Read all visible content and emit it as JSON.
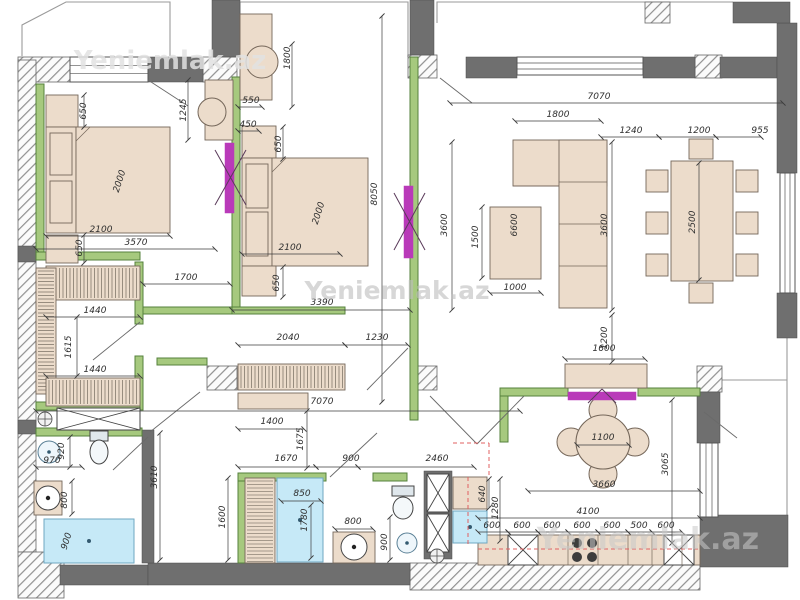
{
  "page": {
    "title": "Apartment floor plan drawing"
  },
  "watermark_text": "Yeniemlak.az",
  "colors": {
    "wall": "#6f6f6f",
    "wall_stroke": "#4c4c4c",
    "green_fill": "#a6c97e",
    "green_stroke": "#55813c",
    "furniture_fill": "#ecdccb",
    "furniture_stroke": "#75675a",
    "blue_fill": "#c6e9f7",
    "blue_stroke": "#6fa7c2",
    "magenta": "#b93ab9",
    "red_dash": "#e06060",
    "dim_line": "#3c3c3c",
    "swing": "#6a6a6a",
    "outline": "#9a9a9a",
    "stripe": "#5f564c",
    "hatch_line": "#909090"
  },
  "plan": {
    "hatched_walls": [
      [
        18,
        57,
        52,
        25
      ],
      [
        203,
        57,
        34,
        25
      ],
      [
        408,
        55,
        29,
        23
      ],
      [
        695,
        55,
        27,
        23
      ],
      [
        645,
        2,
        25,
        21
      ],
      [
        18,
        60,
        18,
        492
      ],
      [
        18,
        552,
        46,
        46
      ],
      [
        207,
        366,
        30,
        24
      ],
      [
        410,
        366,
        27,
        24
      ],
      [
        697,
        366,
        25,
        26
      ],
      [
        410,
        563,
        290,
        27
      ]
    ],
    "solid_walls": [
      [
        212,
        0,
        28,
        57
      ],
      [
        410,
        0,
        24,
        55
      ],
      [
        466,
        57,
        51,
        21
      ],
      [
        643,
        57,
        52,
        21
      ],
      [
        720,
        57,
        57,
        21
      ],
      [
        777,
        23,
        20,
        150
      ],
      [
        777,
        293,
        20,
        45
      ],
      [
        733,
        2,
        57,
        21
      ],
      [
        148,
        57,
        55,
        25
      ],
      [
        697,
        392,
        23,
        51
      ],
      [
        700,
        515,
        88,
        52
      ],
      [
        60,
        565,
        88,
        20
      ],
      [
        148,
        563,
        262,
        22
      ],
      [
        18,
        246,
        18,
        16
      ],
      [
        18,
        420,
        18,
        14
      ],
      [
        142,
        430,
        12,
        133
      ],
      [
        424,
        471,
        28,
        88
      ]
    ],
    "windows": [
      [
        70,
        57,
        78,
        25,
        "h"
      ],
      [
        517,
        57,
        126,
        18,
        "h"
      ],
      [
        780,
        173,
        15,
        120,
        "v"
      ],
      [
        700,
        443,
        18,
        74,
        "v"
      ]
    ],
    "green_walls": [
      [
        36,
        84,
        8,
        168
      ],
      [
        36,
        252,
        104,
        8
      ],
      [
        232,
        77,
        8,
        233
      ],
      [
        410,
        57,
        8,
        363
      ],
      [
        135,
        262,
        8,
        62
      ],
      [
        135,
        356,
        8,
        54
      ],
      [
        36,
        402,
        104,
        8
      ],
      [
        36,
        428,
        106,
        8
      ],
      [
        238,
        473,
        8,
        90
      ],
      [
        238,
        473,
        88,
        8
      ],
      [
        373,
        473,
        34,
        8
      ],
      [
        500,
        388,
        68,
        8
      ],
      [
        638,
        388,
        62,
        8
      ],
      [
        500,
        396,
        8,
        46
      ],
      [
        143,
        307,
        97,
        7
      ],
      [
        232,
        307,
        113,
        7
      ],
      [
        157,
        358,
        50,
        7
      ]
    ],
    "furniture": [
      [
        46,
        95,
        32,
        32
      ],
      [
        46,
        127,
        30,
        106
      ],
      [
        76,
        127,
        94,
        106
      ],
      [
        50,
        133,
        22,
        42
      ],
      [
        50,
        181,
        22,
        42
      ],
      [
        46,
        235,
        32,
        28
      ],
      [
        205,
        80,
        28,
        60
      ],
      [
        240,
        14,
        32,
        86
      ],
      [
        242,
        126,
        34,
        32
      ],
      [
        242,
        158,
        30,
        108
      ],
      [
        272,
        158,
        96,
        108
      ],
      [
        246,
        164,
        22,
        44
      ],
      [
        246,
        212,
        22,
        44
      ],
      [
        242,
        266,
        34,
        30
      ],
      [
        238,
        393,
        70,
        16
      ],
      [
        513,
        140,
        94,
        46
      ],
      [
        559,
        140,
        48,
        168
      ],
      [
        490,
        207,
        51,
        72
      ],
      [
        671,
        161,
        62,
        120
      ],
      [
        646,
        170,
        22,
        22
      ],
      [
        646,
        212,
        22,
        22
      ],
      [
        646,
        254,
        22,
        22
      ],
      [
        736,
        170,
        22,
        22
      ],
      [
        736,
        212,
        22,
        22
      ],
      [
        736,
        254,
        22,
        22
      ],
      [
        689,
        139,
        24,
        20
      ],
      [
        689,
        283,
        24,
        20
      ],
      [
        565,
        364,
        82,
        24
      ],
      [
        478,
        535,
        222,
        30
      ],
      [
        453,
        477,
        34,
        32
      ],
      [
        34,
        481,
        28,
        34
      ],
      [
        333,
        532,
        42,
        31
      ]
    ],
    "striped_items": [
      [
        46,
        266,
        94,
        34,
        "v"
      ],
      [
        36,
        268,
        20,
        126,
        "h"
      ],
      [
        46,
        378,
        94,
        28,
        "v"
      ],
      [
        238,
        364,
        107,
        26,
        "v"
      ],
      [
        245,
        478,
        30,
        85,
        "h"
      ]
    ],
    "xboxes": [
      [
        57,
        408,
        83,
        22
      ],
      [
        427,
        474,
        22,
        38
      ],
      [
        427,
        514,
        22,
        38
      ],
      [
        508,
        535,
        30,
        30
      ],
      [
        664,
        535,
        30,
        30
      ]
    ],
    "blue_items": [
      [
        44,
        519,
        90,
        44
      ],
      [
        277,
        478,
        46,
        84
      ],
      [
        453,
        511,
        34,
        32
      ]
    ],
    "circles": [
      [
        212,
        112,
        14,
        "chair"
      ],
      [
        262,
        62,
        16,
        "chair"
      ],
      [
        49,
        452,
        11,
        "sink"
      ],
      [
        48,
        498,
        12,
        "drum"
      ],
      [
        354,
        547,
        13,
        "drum"
      ],
      [
        407,
        543,
        10,
        "sink"
      ],
      [
        603,
        410,
        14,
        "chairf"
      ],
      [
        603,
        474,
        14,
        "chairf"
      ],
      [
        571,
        442,
        14,
        "chairf"
      ],
      [
        635,
        442,
        14,
        "chairf"
      ],
      [
        603,
        442,
        27,
        "tablef"
      ],
      [
        577,
        543,
        5,
        "burner"
      ],
      [
        592,
        543,
        5,
        "burner"
      ],
      [
        577,
        557,
        5,
        "burner"
      ],
      [
        592,
        557,
        5,
        "burner"
      ],
      [
        437,
        556,
        7,
        "valve"
      ],
      [
        45,
        419,
        7,
        "valve"
      ]
    ],
    "toilets": [
      [
        90,
        431,
        18,
        10,
        99,
        452,
        9,
        12
      ],
      [
        392,
        486,
        22,
        10,
        403,
        508,
        10,
        11
      ]
    ],
    "magenta_doors": [
      [
        225,
        143,
        9,
        70
      ],
      [
        404,
        186,
        9,
        72
      ],
      [
        568,
        392,
        68,
        8
      ]
    ],
    "magenta_xlines": [
      [
        215,
        150,
        246,
        205
      ],
      [
        246,
        150,
        215,
        205
      ],
      [
        394,
        193,
        425,
        250
      ],
      [
        425,
        193,
        394,
        250
      ],
      [
        588,
        403,
        602,
        389
      ],
      [
        602,
        389,
        616,
        403
      ]
    ],
    "door_swings": [
      [
        148,
        80,
        188,
        106
      ],
      [
        93,
        360,
        140,
        322
      ],
      [
        150,
        432,
        200,
        392
      ],
      [
        330,
        477,
        377,
        433
      ],
      [
        430,
        396,
        477,
        444
      ],
      [
        524,
        396,
        477,
        444
      ],
      [
        440,
        78,
        472,
        103
      ],
      [
        704,
        412,
        737,
        438
      ],
      [
        408,
        348,
        367,
        390
      ],
      [
        113,
        470,
        148,
        437
      ]
    ],
    "thin_outlines": [
      "22,56 22,25 66,2 170,2 170,56",
      "240,57 240,2 408,2 408,57",
      "437,23 437,2 733,2",
      "787,338 787,515",
      "722,380 787,380"
    ],
    "detail_lines": [
      [
        559,
        182,
        607,
        182
      ],
      [
        559,
        224,
        607,
        224
      ],
      [
        559,
        266,
        607,
        266
      ],
      [
        513,
        186,
        559,
        186
      ],
      [
        90,
        127,
        76,
        141
      ],
      [
        286,
        158,
        272,
        172
      ],
      [
        538,
        535,
        538,
        565
      ],
      [
        568,
        535,
        568,
        565
      ],
      [
        598,
        535,
        598,
        565
      ],
      [
        628,
        535,
        628,
        565
      ],
      [
        652,
        535,
        652,
        565
      ],
      [
        682,
        535,
        682,
        565
      ]
    ],
    "red_dash_lines": [
      [
        468,
        477,
        468,
        545
      ],
      [
        478,
        549,
        698,
        549
      ],
      [
        489,
        443,
        489,
        477
      ],
      [
        453,
        443,
        489,
        443
      ]
    ],
    "dim_lines": [
      [
        36,
        249,
        215,
        249
      ],
      [
        46,
        236,
        170,
        236
      ],
      [
        84,
        95,
        84,
        127
      ],
      [
        84,
        235,
        84,
        263
      ],
      [
        143,
        284,
        230,
        284
      ],
      [
        46,
        317,
        140,
        317
      ],
      [
        46,
        376,
        140,
        376
      ],
      [
        77,
        317,
        77,
        376
      ],
      [
        188,
        80,
        188,
        140
      ],
      [
        238,
        107,
        262,
        107
      ],
      [
        292,
        44,
        292,
        107
      ],
      [
        238,
        131,
        259,
        131
      ],
      [
        283,
        127,
        283,
        159
      ],
      [
        283,
        267,
        283,
        297
      ],
      [
        242,
        254,
        340,
        254
      ],
      [
        232,
        310,
        410,
        310
      ],
      [
        382,
        16,
        382,
        402
      ],
      [
        238,
        345,
        345,
        345
      ],
      [
        345,
        345,
        408,
        345
      ],
      [
        238,
        429,
        304,
        429
      ],
      [
        36,
        411,
        520,
        411
      ],
      [
        307,
        411,
        307,
        468
      ],
      [
        238,
        467,
        316,
        467
      ],
      [
        316,
        467,
        358,
        467
      ],
      [
        358,
        467,
        474,
        467
      ],
      [
        160,
        433,
        160,
        560
      ],
      [
        228,
        478,
        228,
        560
      ],
      [
        281,
        501,
        321,
        501
      ],
      [
        311,
        505,
        311,
        558
      ],
      [
        335,
        529,
        373,
        529
      ],
      [
        390,
        517,
        390,
        560
      ],
      [
        36,
        467,
        82,
        467
      ],
      [
        70,
        437,
        70,
        467
      ],
      [
        72,
        481,
        72,
        514
      ],
      [
        450,
        103,
        783,
        103
      ],
      [
        515,
        121,
        601,
        121
      ],
      [
        601,
        137,
        659,
        137
      ],
      [
        659,
        137,
        716,
        137
      ],
      [
        716,
        137,
        761,
        137
      ],
      [
        452,
        142,
        452,
        310
      ],
      [
        612,
        142,
        612,
        310
      ],
      [
        482,
        207,
        482,
        278
      ],
      [
        490,
        293,
        541,
        293
      ],
      [
        699,
        163,
        699,
        280
      ],
      [
        612,
        315,
        612,
        362
      ],
      [
        565,
        359,
        645,
        359
      ],
      [
        577,
        445,
        629,
        445
      ],
      [
        528,
        491,
        700,
        491
      ],
      [
        672,
        400,
        672,
        543
      ],
      [
        478,
        518,
        700,
        518
      ],
      [
        478,
        532,
        508,
        532
      ],
      [
        508,
        532,
        538,
        532
      ],
      [
        538,
        532,
        568,
        532
      ],
      [
        568,
        532,
        598,
        532
      ],
      [
        598,
        532,
        628,
        532
      ],
      [
        628,
        532,
        652,
        532
      ],
      [
        652,
        532,
        682,
        532
      ],
      [
        489,
        479,
        489,
        508
      ],
      [
        500,
        479,
        500,
        541
      ]
    ],
    "dim_labels": [
      [
        "650",
        86,
        111,
        -90
      ],
      [
        "2000",
        122,
        182,
        -72
      ],
      [
        "2100",
        101,
        232,
        0
      ],
      [
        "650",
        82,
        248,
        -90
      ],
      [
        "3570",
        136,
        245,
        0
      ],
      [
        "1245",
        186,
        110,
        -90
      ],
      [
        "1700",
        186,
        280,
        0
      ],
      [
        "1440",
        95,
        313,
        0
      ],
      [
        "1615",
        71,
        347,
        -90
      ],
      [
        "1440",
        95,
        372,
        0
      ],
      [
        "550",
        251,
        103,
        0
      ],
      [
        "1800",
        290,
        58,
        -90
      ],
      [
        "450",
        248,
        127,
        0
      ],
      [
        "650",
        281,
        144,
        -90
      ],
      [
        "2000",
        321,
        214,
        -72
      ],
      [
        "2100",
        290,
        250,
        0
      ],
      [
        "650",
        279,
        283,
        -90
      ],
      [
        "3390",
        322,
        305,
        0
      ],
      [
        "8050",
        377,
        194,
        -90
      ],
      [
        "2040",
        288,
        340,
        0
      ],
      [
        "1230",
        377,
        340,
        0
      ],
      [
        "1400",
        272,
        424,
        0
      ],
      [
        "7070",
        322,
        404,
        0
      ],
      [
        "1675",
        303,
        439,
        -90
      ],
      [
        "7070",
        599,
        99,
        0
      ],
      [
        "1800",
        558,
        117,
        0
      ],
      [
        "1240",
        631,
        133,
        0
      ],
      [
        "1200",
        699,
        133,
        0
      ],
      [
        "955",
        760,
        133,
        0
      ],
      [
        "3600",
        447,
        225,
        -90
      ],
      [
        "3600",
        607,
        225,
        -90
      ],
      [
        "1500",
        478,
        237,
        -90
      ],
      [
        "6600",
        517,
        225,
        -90
      ],
      [
        "1000",
        515,
        290,
        0
      ],
      [
        "2500",
        695,
        222,
        -90
      ],
      [
        "1200",
        607,
        338,
        -90
      ],
      [
        "1600",
        604,
        351,
        0
      ],
      [
        "1100",
        603,
        440,
        0
      ],
      [
        "3660",
        604,
        487,
        0
      ],
      [
        "3065",
        668,
        464,
        -90
      ],
      [
        "4100",
        588,
        514,
        0
      ],
      [
        "600",
        492,
        528,
        0
      ],
      [
        "600",
        522,
        528,
        0
      ],
      [
        "600",
        552,
        528,
        0
      ],
      [
        "600",
        582,
        528,
        0
      ],
      [
        "600",
        612,
        528,
        0
      ],
      [
        "500",
        639,
        528,
        0
      ],
      [
        "600",
        666,
        528,
        0
      ],
      [
        "640",
        485,
        494,
        -90
      ],
      [
        "1280",
        498,
        508,
        -90
      ],
      [
        "2460",
        437,
        461,
        0
      ],
      [
        "900",
        351,
        461,
        0
      ],
      [
        "1670",
        286,
        461,
        0
      ],
      [
        "850",
        302,
        496,
        0
      ],
      [
        "1780",
        307,
        520,
        -90
      ],
      [
        "800",
        353,
        524,
        0
      ],
      [
        "900",
        387,
        542,
        -90
      ],
      [
        "1600",
        225,
        517,
        -90
      ],
      [
        "3610",
        157,
        477,
        -90
      ],
      [
        "970",
        52,
        463,
        0
      ],
      [
        "920",
        64,
        451,
        -90
      ],
      [
        "800",
        67,
        500,
        -90
      ],
      [
        "900",
        69,
        542,
        -72
      ]
    ],
    "watermarks": [
      [
        "Yeniemlak.az",
        170,
        69,
        26,
        "#e2e2e2",
        0.85
      ],
      [
        "Yeniemlak.az",
        397,
        299,
        25,
        "#bdbdbd",
        0.6
      ],
      [
        "Yeniemlak.az",
        648,
        549,
        30,
        "#c9c9c9",
        0.55
      ]
    ]
  }
}
